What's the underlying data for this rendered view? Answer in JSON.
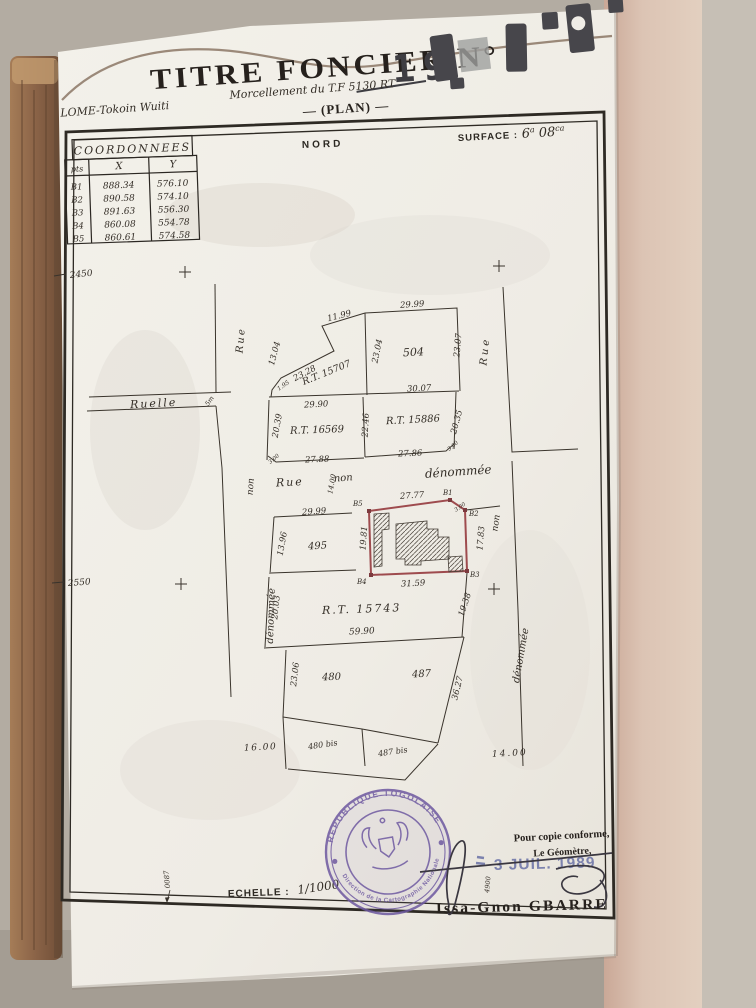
{
  "colors": {
    "paper": "#f0ede7",
    "ink": "#3a342c",
    "parcel_outline_red": "#9e4b4e",
    "stamp_purple": "#6d58a0",
    "date_blue": "#7c82ae",
    "cardboard_brown": "#8d6a4f",
    "pink_band": "#d9bfb1"
  },
  "header": {
    "title": "TITRE FONCIER N°",
    "number": "19",
    "location": "LOME-Tokoin Wuiti",
    "subtitle": "Morcellement du T.F 5130 RT",
    "plan_label": "— (PLAN) —"
  },
  "coordinates_table": {
    "title": "COORDONNEES",
    "columns": [
      "pts",
      "X",
      "Y"
    ],
    "rows": [
      [
        "B1",
        "888.34",
        "576.10"
      ],
      [
        "B2",
        "890.58",
        "574.10"
      ],
      [
        "B3",
        "891.63",
        "556.30"
      ],
      [
        "B4",
        "860.08",
        "554.78"
      ],
      [
        "B5",
        "860.61",
        "574.58"
      ]
    ]
  },
  "compass": {
    "north": "NORD"
  },
  "surface": {
    "label": "SURFACE :",
    "a_value": "6",
    "a_unit": "a",
    "ca_value": "08",
    "ca_unit": "ca"
  },
  "margins": {
    "left_top": "2450",
    "left_mid": "2550",
    "bottom_vert": "0087"
  },
  "streets": {
    "rue_left": "Rue",
    "ruelle": "Ruelle",
    "ruelle_width": "5m",
    "left_non": "non",
    "left_denommee": "dénommée",
    "mid_rue": "Rue",
    "mid_non": "non",
    "mid_denommee": "dénommée",
    "mid_width": "14.00",
    "right_rue": "Rue",
    "right_non": "non",
    "right_denommee": "dénommée"
  },
  "parcels": {
    "p504": "504",
    "rt15707": "R.T. 15707",
    "rt16569": "R.T. 16569",
    "rt15886": "R.T. 15886",
    "p495": "495",
    "rt15743": "R.T. 15743",
    "p480": "480",
    "p487": "487",
    "p480bis": "480 bis",
    "p487bis": "487 bis"
  },
  "points": {
    "b1": "B1",
    "b2": "B2",
    "b3": "B3",
    "b4": "B4",
    "b5": "B5"
  },
  "measurements": {
    "m1199": "11.99",
    "m2999a": "29.99",
    "m2307": "23.07",
    "m2304": "23.04",
    "m1304": "13.04",
    "m2328": "23.28",
    "m195": "1.95",
    "m3007": "30.07",
    "m2990": "29.90",
    "m2039": "20.39",
    "m2246": "22.46",
    "m2035": "20.35",
    "m2788": "27.88",
    "m2786": "27.86",
    "c300a": "3.00",
    "c300b": "3.00",
    "c300c": "3.00",
    "m2999b": "29.99",
    "m1396": "13.96",
    "m1981": "19.81",
    "m2777": "27.77",
    "m1783": "17.83",
    "m3159": "31.59",
    "m2003": "20.03",
    "m1938": "19.38",
    "m5990": "59.90",
    "m2306": "23.06",
    "m3627": "36.27",
    "m1600": "16.00",
    "m1400": "14.00"
  },
  "scale": {
    "label": "ECHELLE :",
    "value": "1/1000"
  },
  "certification": {
    "stamp_top": "REPUBLIQUE TOGOLAISE",
    "stamp_bottom": "Direction de la Cartographie Nationale",
    "copy_line1": "Pour copie conforme,",
    "copy_line2": "Le Géomètre,",
    "date": "3 JUIL. 1989",
    "surveyor": "Issa-Gnon GBARRE",
    "note": "4900"
  }
}
